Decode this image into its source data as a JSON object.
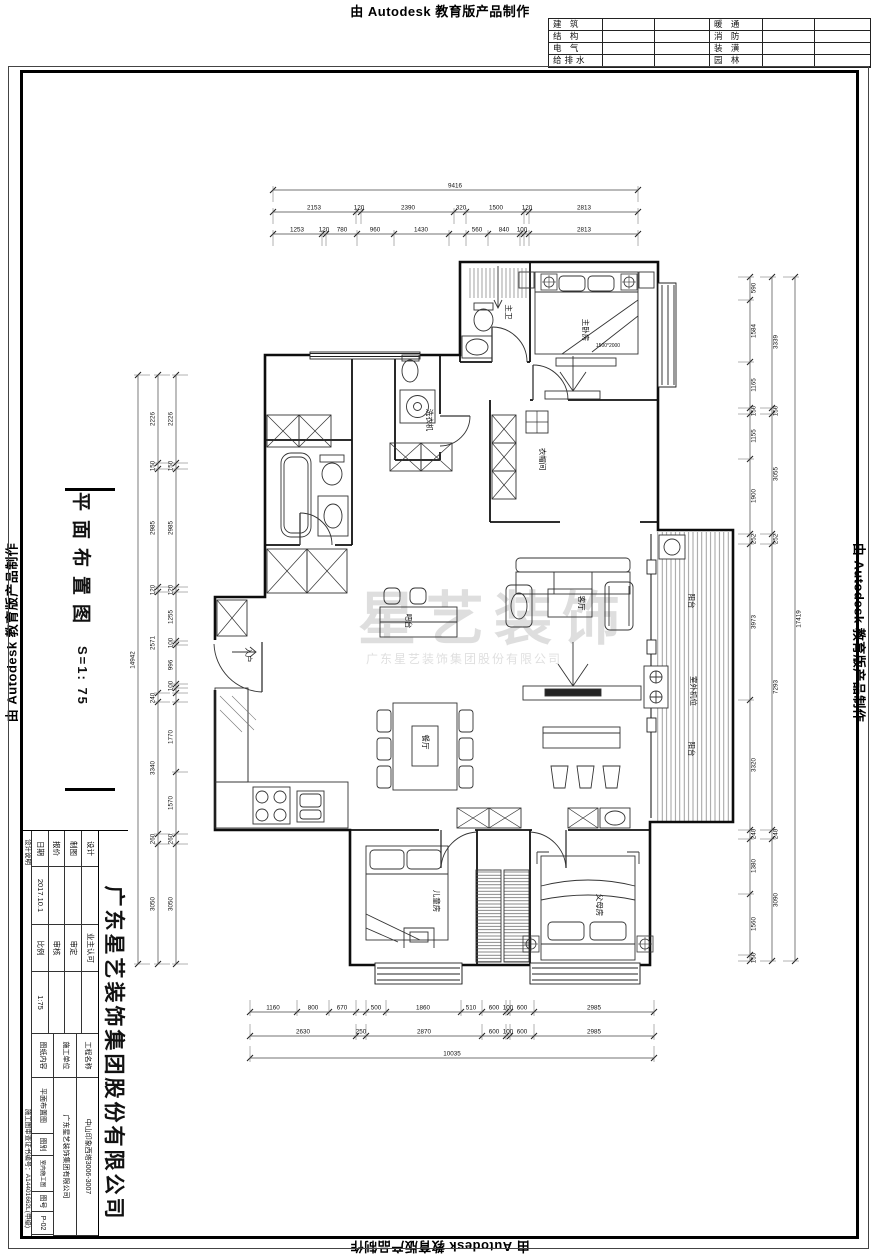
{
  "stamp": {
    "text": "由 Autodesk 教育版产品制作"
  },
  "discipline_table": {
    "rows": [
      [
        "建 筑",
        "暖 通"
      ],
      [
        "结 构",
        "消 防"
      ],
      [
        "电 气",
        "装 潢"
      ],
      [
        "给排水",
        "园 林"
      ]
    ]
  },
  "sheet_title": {
    "text": "平面布置图",
    "scale_text": "S=1: 75"
  },
  "watermark": {
    "line1": "星艺装饰",
    "line2": "广东星艺装饰集团股份有限公司"
  },
  "title_block": {
    "company": "广东星艺装饰集团股份有限公司",
    "rows_left": [
      [
        "设计",
        "",
        "业主认可",
        ""
      ],
      [
        "制图",
        "",
        "审定",
        ""
      ],
      [
        "报价",
        "",
        "审核",
        ""
      ],
      [
        "日期",
        "2017.10.1",
        "比例",
        "1:75"
      ]
    ],
    "rows_right": [
      [
        "工程名称",
        "中山印象西塔3006-3007"
      ],
      [
        "施工单位",
        "广东星艺装饰集团有限公司"
      ],
      [
        "图纸内容",
        "平面布置图",
        "图别",
        "室内施工图",
        "图号",
        "P-02"
      ]
    ],
    "note_left": "设计说明",
    "cert": "施工图审查证书编号：A14401662L(甲级)"
  },
  "plan": {
    "room_labels": [
      {
        "t": "主卫",
        "x": 506,
        "y": 312
      },
      {
        "t": "主卧房",
        "x": 583,
        "y": 330
      },
      {
        "t": "洗衣机",
        "x": 427,
        "y": 420
      },
      {
        "t": "衣帽间",
        "x": 540,
        "y": 459
      },
      {
        "t": "入户",
        "x": 246,
        "y": 655
      },
      {
        "t": "吧台",
        "x": 406,
        "y": 621
      },
      {
        "t": "客厅",
        "x": 579,
        "y": 603
      },
      {
        "t": "餐厅",
        "x": 423,
        "y": 742
      },
      {
        "t": "阳台",
        "x": 689,
        "y": 601
      },
      {
        "t": "室外机位",
        "x": 691,
        "y": 691
      },
      {
        "t": "阳台",
        "x": 689,
        "y": 749
      },
      {
        "t": "儿童房",
        "x": 434,
        "y": 901
      },
      {
        "t": "父母房",
        "x": 597,
        "y": 905
      }
    ],
    "notes": [
      {
        "t": "1500*2000",
        "x": 608,
        "y": 347
      }
    ],
    "dims": {
      "h_rows": [
        {
          "y": 190,
          "x1": 273,
          "x2": 638,
          "ticks": [
            273,
            638
          ],
          "labels": [
            {
              "t": "9416",
              "x": 455
            }
          ]
        },
        {
          "y": 212,
          "x1": 273,
          "x2": 638,
          "ticks": [
            273,
            356,
            361,
            454,
            466,
            524,
            529,
            638
          ],
          "labels": [
            {
              "t": "2153",
              "x": 314
            },
            {
              "t": "120",
              "x": 359
            },
            {
              "t": "2390",
              "x": 408
            },
            {
              "t": "320",
              "x": 461
            },
            {
              "t": "1500",
              "x": 496
            },
            {
              "t": "120",
              "x": 527
            },
            {
              "t": "2813",
              "x": 584
            }
          ]
        },
        {
          "y": 234,
          "x1": 273,
          "x2": 638,
          "ticks": [
            273,
            322,
            326,
            357,
            394,
            449,
            466,
            488,
            520,
            524,
            529,
            638
          ],
          "labels": [
            {
              "t": "1253",
              "x": 297
            },
            {
              "t": "120",
              "x": 324
            },
            {
              "t": "780",
              "x": 342
            },
            {
              "t": "960",
              "x": 375
            },
            {
              "t": "1430",
              "x": 421
            },
            {
              "t": "560",
              "x": 477
            },
            {
              "t": "840",
              "x": 504
            },
            {
              "t": "100",
              "x": 522
            },
            {
              "t": "2813",
              "x": 584
            }
          ]
        },
        {
          "y": 1012,
          "x1": 250,
          "x2": 654,
          "ticks": [
            250,
            297,
            329,
            356,
            366,
            386,
            461,
            482,
            506,
            510,
            534,
            654
          ],
          "labels": [
            {
              "t": "1160",
              "x": 273
            },
            {
              "t": "800",
              "x": 313
            },
            {
              "t": "670",
              "x": 342
            },
            {
              "t": "500",
              "x": 376
            },
            {
              "t": "1860",
              "x": 423
            },
            {
              "t": "510",
              "x": 471
            },
            {
              "t": "600",
              "x": 494
            },
            {
              "t": "100",
              "x": 508
            },
            {
              "t": "600",
              "x": 522
            },
            {
              "t": "2985",
              "x": 594
            }
          ]
        },
        {
          "y": 1036,
          "x1": 250,
          "x2": 654,
          "ticks": [
            250,
            356,
            366,
            482,
            506,
            510,
            534,
            654
          ],
          "labels": [
            {
              "t": "2630",
              "x": 303
            },
            {
              "t": "250",
              "x": 361
            },
            {
              "t": "2870",
              "x": 424
            },
            {
              "t": "600",
              "x": 494
            },
            {
              "t": "100",
              "x": 508
            },
            {
              "t": "600",
              "x": 522
            },
            {
              "t": "2985",
              "x": 594
            }
          ]
        },
        {
          "y": 1058,
          "x1": 250,
          "x2": 654,
          "ticks": [
            250,
            654
          ],
          "labels": [
            {
              "t": "10035",
              "x": 452
            }
          ]
        }
      ],
      "v_cols": [
        {
          "x": 138,
          "y1": 375,
          "y2": 964,
          "ticks": [
            375,
            964
          ],
          "labels": [
            {
              "t": "14942",
              "y": 660
            }
          ]
        },
        {
          "x": 158,
          "y1": 375,
          "y2": 964,
          "ticks": [
            375,
            463,
            469,
            587,
            592,
            693,
            702,
            834,
            844,
            964
          ],
          "labels": [
            {
              "t": "2226",
              "y": 419
            },
            {
              "t": "150",
              "y": 466
            },
            {
              "t": "2985",
              "y": 528
            },
            {
              "t": "120",
              "y": 590
            },
            {
              "t": "2571",
              "y": 643
            },
            {
              "t": "240",
              "y": 698
            },
            {
              "t": "3340",
              "y": 768
            },
            {
              "t": "260",
              "y": 839
            },
            {
              "t": "3050",
              "y": 904
            }
          ]
        },
        {
          "x": 176,
          "y1": 375,
          "y2": 964,
          "ticks": [
            375,
            463,
            469,
            587,
            592,
            641,
            645,
            684,
            688,
            693,
            702,
            772,
            834,
            844,
            964
          ],
          "labels": [
            {
              "t": "2226",
              "y": 419
            },
            {
              "t": "150",
              "y": 466
            },
            {
              "t": "2985",
              "y": 528
            },
            {
              "t": "120",
              "y": 590
            },
            {
              "t": "1255",
              "y": 617
            },
            {
              "t": "100",
              "y": 643
            },
            {
              "t": "996",
              "y": 665
            },
            {
              "t": "100",
              "y": 686
            },
            {
              "t": "1770",
              "y": 737
            },
            {
              "t": "1570",
              "y": 803
            },
            {
              "t": "260",
              "y": 839
            },
            {
              "t": "3050",
              "y": 904
            }
          ]
        },
        {
          "x": 750,
          "y1": 277,
          "y2": 961,
          "ticks": [
            277,
            300,
            362,
            408,
            414,
            459,
            534,
            544,
            700,
            830,
            839,
            894,
            955,
            961
          ],
          "labels": [
            {
              "t": "590",
              "y": 288
            },
            {
              "t": "1584",
              "y": 331
            },
            {
              "t": "1165",
              "y": 385
            },
            {
              "t": "150",
              "y": 411
            },
            {
              "t": "1155",
              "y": 436
            },
            {
              "t": "1900",
              "y": 496
            },
            {
              "t": "252",
              "y": 539
            },
            {
              "t": "3973",
              "y": 622
            },
            {
              "t": "3320",
              "y": 765
            },
            {
              "t": "240",
              "y": 834
            },
            {
              "t": "1380",
              "y": 866
            },
            {
              "t": "1560",
              "y": 924
            },
            {
              "t": "150",
              "y": 958
            }
          ]
        },
        {
          "x": 772,
          "y1": 277,
          "y2": 961,
          "ticks": [
            277,
            408,
            414,
            534,
            544,
            830,
            839,
            961
          ],
          "labels": [
            {
              "t": "3339",
              "y": 342
            },
            {
              "t": "150",
              "y": 411
            },
            {
              "t": "3055",
              "y": 474
            },
            {
              "t": "252",
              "y": 539
            },
            {
              "t": "7293",
              "y": 687
            },
            {
              "t": "240",
              "y": 834
            },
            {
              "t": "3090",
              "y": 900
            }
          ]
        },
        {
          "x": 795,
          "y1": 277,
          "y2": 961,
          "ticks": [
            277,
            961
          ],
          "labels": [
            {
              "t": "17419",
              "y": 619
            }
          ]
        }
      ]
    }
  }
}
